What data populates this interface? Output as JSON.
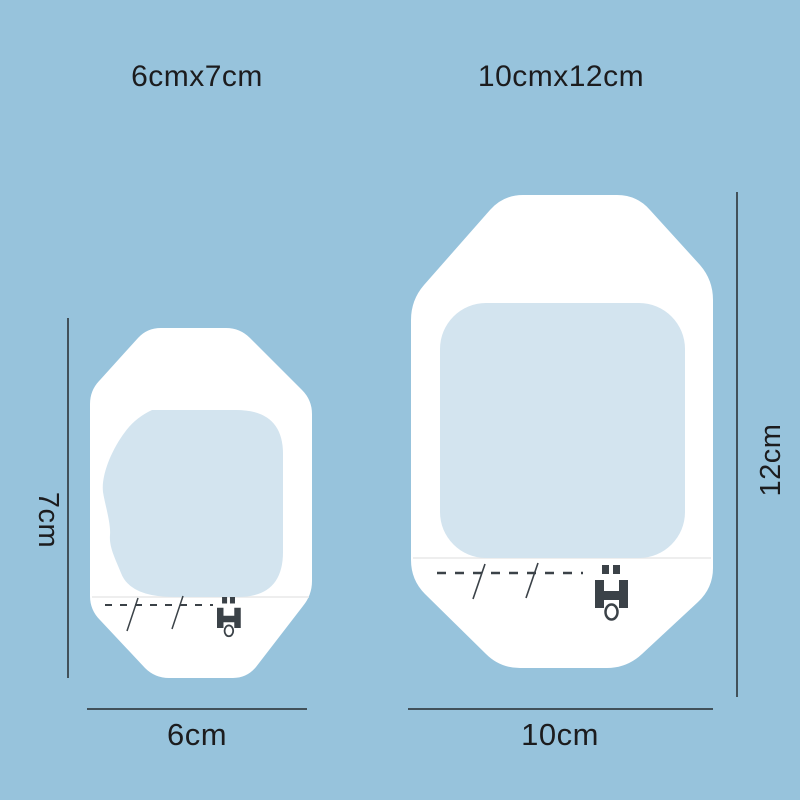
{
  "title_labels": {
    "small": "6cmx7cm",
    "large": "10cmx12cm"
  },
  "dimensions": {
    "small": {
      "width": "6cm",
      "height": "7cm"
    },
    "large": {
      "width": "10cm",
      "height": "12cm"
    }
  },
  "products": [
    {
      "name": "transparent film dressing",
      "size_label": "6cmx7cm",
      "print_icon": "catheter-clamp-icon",
      "markings": "perforation dashes with tear slashes"
    },
    {
      "name": "transparent film dressing",
      "size_label": "10cmx12cm",
      "print_icon": "catheter-clamp-icon",
      "markings": "perforation dashes with tear slashes"
    }
  ],
  "colors": {
    "background": "#97c3dc",
    "dressing_white": "#ffffff",
    "pane_blue": "#d3e4ef",
    "seam_gray": "#e8e8e8",
    "text_ink": "#1c1c1e",
    "dimension_line": "#42515a",
    "marking_dark": "#3b4248"
  }
}
